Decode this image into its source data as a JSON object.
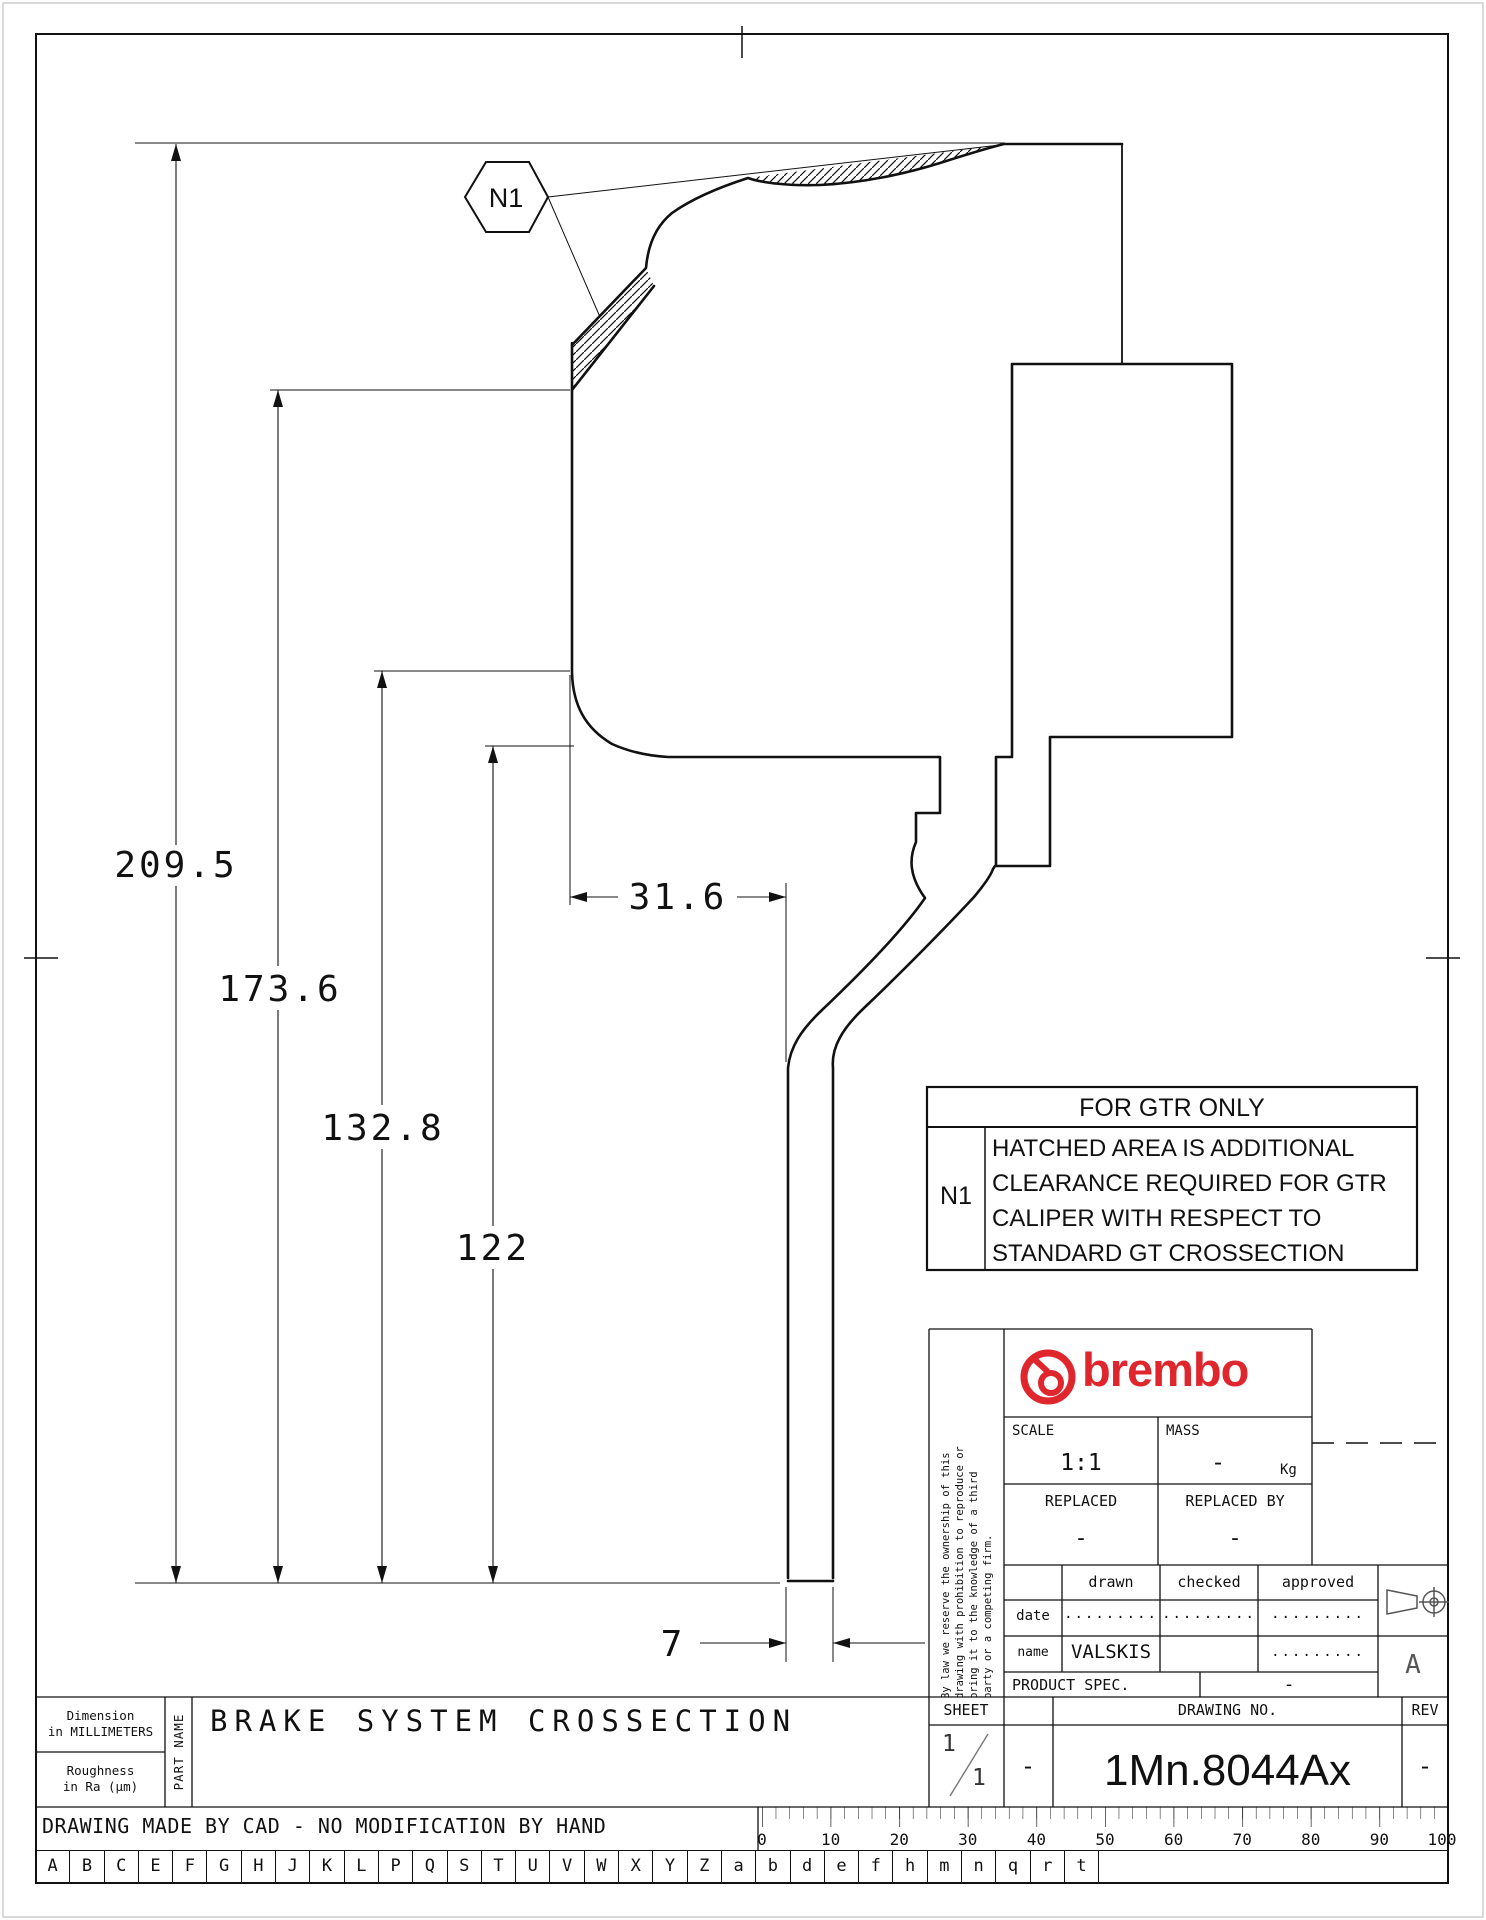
{
  "drawing": {
    "callout": "N1",
    "dims": [
      "209.5",
      "173.6",
      "132.8",
      "122",
      "31.6",
      "7"
    ]
  },
  "gtr_table": {
    "title": "FOR GTR ONLY",
    "ref": "N1",
    "lines": [
      "HATCHED AREA IS ADDITIONAL",
      "CLEARANCE REQUIRED FOR GTR",
      "CALIPER WITH RESPECT TO",
      "STANDARD GT CROSSECTION"
    ]
  },
  "title_block": {
    "legal_line1": "By law we reserve the ownership of this",
    "legal_line2": "drawing with prohibition to reproduce or",
    "legal_line3": "bring it to the knowledge of a third",
    "legal_line4": "party or a competing firm.",
    "brand": "brembo",
    "scale_label": "SCALE",
    "scale_value": "1:1",
    "mass_label": "MASS",
    "mass_value": "-",
    "mass_unit": "Kg",
    "replaced_label": "REPLACED",
    "replaced_value": "-",
    "replaced_by_label": "REPLACED BY",
    "replaced_by_value": "-",
    "drawn_label": "drawn",
    "checked_label": "checked",
    "approved_label": "approved",
    "date_label": "date",
    "name_label": "name",
    "date_drawn": ".........",
    "date_checked": ".........",
    "date_approved": ".........",
    "name_drawn": "VALSKIS",
    "name_approved": ".........",
    "product_spec_label": "PRODUCT SPEC.",
    "product_spec_value": "-",
    "projection_letter": "A",
    "sheet_label": "SHEET",
    "sheet_num": "1",
    "sheet_den": "1",
    "sheet_dash": "-",
    "drawing_no_label": "DRAWING NO.",
    "drawing_no": "1Mn.8044Ax",
    "rev_label": "REV",
    "rev_value": "-"
  },
  "footer": {
    "dimension_note_1": "Dimension",
    "dimension_note_2": "in MILLIMETERS",
    "roughness_note_1": "Roughness",
    "roughness_note_2": "in Ra (μm)",
    "part_name_label": "PART NAME",
    "part_name": "BRAKE SYSTEM CROSSECTION",
    "cad_note": "DRAWING MADE BY CAD - NO MODIFICATION BY HAND",
    "ruler_labels": [
      "0",
      "10",
      "20",
      "30",
      "40",
      "50",
      "60",
      "70",
      "80",
      "90",
      "100"
    ],
    "index_letters": [
      "A",
      "B",
      "C",
      "E",
      "F",
      "G",
      "H",
      "J",
      "K",
      "L",
      "P",
      "Q",
      "S",
      "T",
      "U",
      "V",
      "W",
      "X",
      "Y",
      "Z",
      "a",
      "b",
      "d",
      "e",
      "f",
      "h",
      "m",
      "n",
      "q",
      "r",
      "t"
    ]
  },
  "colors": {
    "line": "#111111",
    "brand_red": "#e0262d",
    "paper": "#ffffff"
  }
}
